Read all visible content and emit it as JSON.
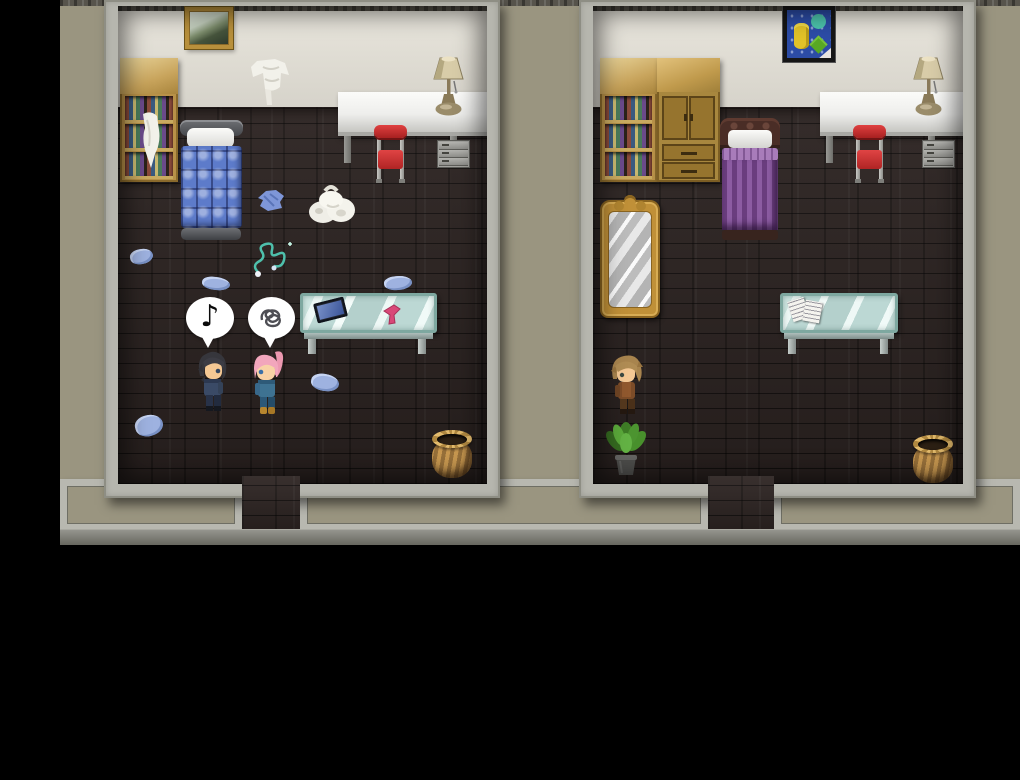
{
  "scene": {
    "title": "Two-Room Apartment Interior",
    "style": "top-down pixel RPG cutaway of two bedrooms",
    "background_color": "#000000",
    "exterior_wall_color": "#9a9580",
    "trim_color": "#b8b8b0",
    "interior_wall_color": "#e0ddd4",
    "floor_color": "#2e2523",
    "baseboard_color": "#84847e",
    "doorways": 2
  },
  "left_room": {
    "name": "left bedroom (messy)",
    "furniture": [
      {
        "name": "landscape-painting",
        "desc": "gold framed landscape picture on wall"
      },
      {
        "name": "bookshelf",
        "desc": "wooden bookshelf with books and a white cloth draped on a shelf"
      },
      {
        "name": "blue-bed",
        "desc": "single bed, gray rails, white pillow, blue quilted cover"
      },
      {
        "name": "hanging-laundry",
        "desc": "white clothes hung on the wall"
      },
      {
        "name": "white-counter",
        "desc": "white counter desk along the wall"
      },
      {
        "name": "table-lamp",
        "desc": "beige table lamp on counter"
      },
      {
        "name": "red-chair",
        "desc": "red metal-frame chair"
      },
      {
        "name": "drawer-cabinet",
        "desc": "small gray drawer unit"
      },
      {
        "name": "glass-table",
        "desc": "glass display table",
        "items": [
          "tablet-device",
          "pink-hair-dryer"
        ]
      },
      {
        "name": "clothes-pile",
        "desc": "white laundry pile on the floor"
      },
      {
        "name": "blue-shirt",
        "desc": "blue shirt dropped on the floor"
      },
      {
        "name": "teal-necklace",
        "desc": "teal beaded necklace on the floor"
      },
      {
        "name": "scattered-garments",
        "count": 5,
        "desc": "light blue garments scattered on the floor"
      },
      {
        "name": "wicker-basket",
        "desc": "round woven basket"
      }
    ],
    "characters": [
      {
        "name": "dark-haired-man",
        "hair_color": "#3a3a40",
        "outfit_color": "#3a4a66",
        "facing": "right",
        "emote": "music-note"
      },
      {
        "name": "pink-haired-woman",
        "hair_color": "#f2a6bc",
        "outfit_color": "#3e7292",
        "facing": "left",
        "emote": "frustration-scribble"
      }
    ],
    "emotes": {
      "music_note_glyph": "♪"
    }
  },
  "right_room": {
    "name": "right bedroom (tidy)",
    "furniture": [
      {
        "name": "abstract-painting",
        "desc": "colorful abstract art in a black frame"
      },
      {
        "name": "bookshelf",
        "desc": "wooden bookshelf with books"
      },
      {
        "name": "wardrobe",
        "desc": "wooden wardrobe with two doors and two drawers"
      },
      {
        "name": "purple-bed",
        "desc": "single bed, carved dark headboard, white pillow, purple striped cover"
      },
      {
        "name": "white-counter",
        "desc": "white counter desk along the wall"
      },
      {
        "name": "table-lamp",
        "desc": "beige table lamp on counter"
      },
      {
        "name": "red-chair",
        "desc": "red metal-frame chair"
      },
      {
        "name": "drawer-cabinet",
        "desc": "small gray drawer unit"
      },
      {
        "name": "standing-mirror",
        "desc": "ornate gold full-length mirror"
      },
      {
        "name": "glass-table",
        "desc": "glass display table",
        "items": [
          "papers"
        ]
      },
      {
        "name": "potted-plant",
        "desc": "leafy green plant in a gray pot"
      },
      {
        "name": "wicker-basket",
        "desc": "round woven basket"
      }
    ],
    "characters": [
      {
        "name": "brown-haired-man",
        "hair_color": "#a8844e",
        "outfit_color": "#7c4c28",
        "facing": "down-left",
        "emote": null
      }
    ]
  }
}
